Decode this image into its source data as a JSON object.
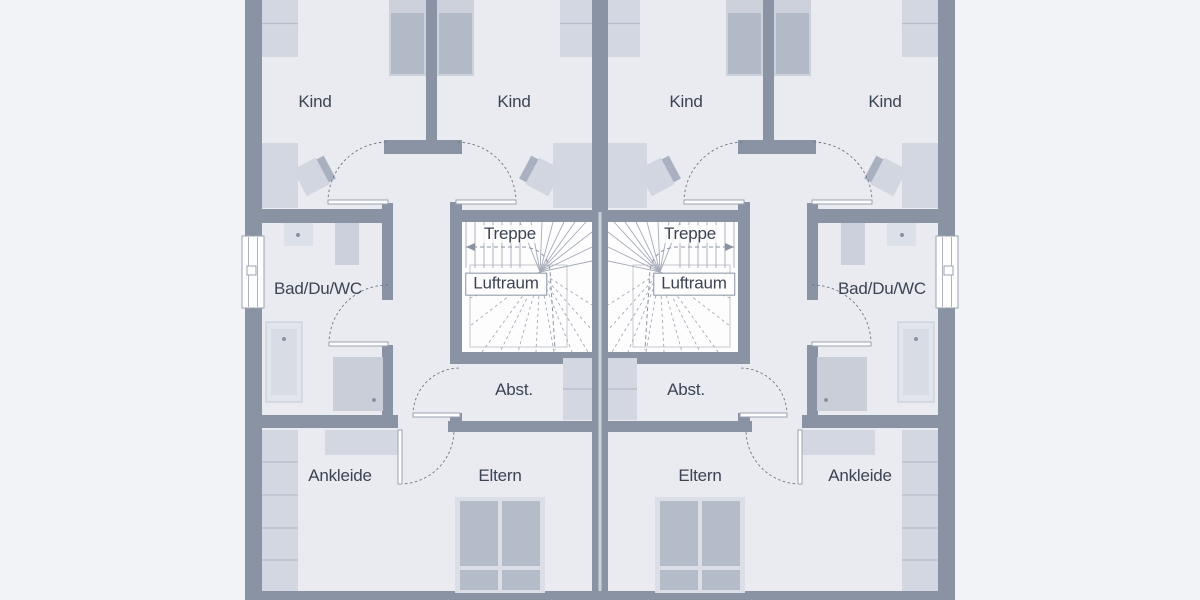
{
  "plan_type": "floor-plan-duplex-upper-storey",
  "colors": {
    "outside": "#f2f3f6",
    "floor": "#e9ebf1",
    "wall": "#8a93a4",
    "wall_seam": "#ccd1da",
    "stair_bg": "#fdfdfe",
    "stair_line": "#a5abb8",
    "void_line": "#b3b9c4",
    "walk_line": "#8a93a2",
    "furn_light": "#d3d7e1",
    "furn_mid": "#c9ced9",
    "bed_dark": "#b2b9c7",
    "bed_base": "#ccd1db",
    "dbl_bed_base": "#dbdee6",
    "dbl_bed_panel": "#b4bbc9",
    "tub_base": "#e2e5eb",
    "tub_inner": "#d8dce4",
    "tub_stroke": "#c4cad6",
    "basin": "#dce0e8",
    "wc": "#cbd0dc",
    "desk": "#d2d6e0",
    "desk_stripe": "#a9b0bf",
    "furn_line": "#b6bcc9",
    "door_arc": "#6e7482",
    "door_leaf_stroke": "#9aa2b1",
    "window_frame": "#9aa2b1",
    "dot": "#8a93a4",
    "text": "#3c4352"
  },
  "labels": [
    {
      "text": "Kind",
      "x": 315,
      "y": 102
    },
    {
      "text": "Kind",
      "x": 514,
      "y": 102
    },
    {
      "text": "Kind",
      "x": 686,
      "y": 102
    },
    {
      "text": "Kind",
      "x": 885,
      "y": 102
    },
    {
      "text": "Treppe",
      "x": 510,
      "y": 234,
      "halo": true
    },
    {
      "text": "Treppe",
      "x": 690,
      "y": 234,
      "halo": true
    },
    {
      "text": "Luftraum",
      "x": 506,
      "y": 284,
      "boxed": true
    },
    {
      "text": "Luftraum",
      "x": 694,
      "y": 284,
      "boxed": true
    },
    {
      "text": "Bad/Du/WC",
      "x": 318,
      "y": 289
    },
    {
      "text": "Bad/Du/WC",
      "x": 882,
      "y": 289
    },
    {
      "text": "Abst.",
      "x": 514,
      "y": 390
    },
    {
      "text": "Abst.",
      "x": 686,
      "y": 390
    },
    {
      "text": "Ankleide",
      "x": 340,
      "y": 476
    },
    {
      "text": "Eltern",
      "x": 500,
      "y": 476
    },
    {
      "text": "Eltern",
      "x": 700,
      "y": 476
    },
    {
      "text": "Ankleide",
      "x": 860,
      "y": 476
    }
  ],
  "shared": {
    "floor": [
      245,
      0,
      710,
      600
    ],
    "walls": [
      {
        "name": "outer-wall-left",
        "r": [
          245,
          0,
          17,
          600
        ]
      },
      {
        "name": "outer-wall-right",
        "r": [
          938,
          0,
          17,
          600
        ]
      },
      {
        "name": "outer-wall-bottom",
        "r": [
          245,
          591,
          710,
          9
        ]
      },
      {
        "name": "party-wall",
        "r": [
          592,
          0,
          16,
          591
        ]
      }
    ],
    "party_seam": [
      598.5,
      212,
      3,
      379
    ]
  },
  "unit": {
    "walls": [
      {
        "name": "kind-divider-wall",
        "r": [
          426,
          0,
          11,
          140
        ]
      },
      {
        "name": "hall-wing-wall",
        "r": [
          384,
          140,
          78,
          14
        ]
      },
      {
        "name": "hall-stub-wall",
        "r": [
          382,
          203,
          11,
          21
        ]
      },
      {
        "name": "bath-top-wall",
        "r": [
          262,
          209,
          120,
          14
        ]
      },
      {
        "name": "bath-right-wall-upper",
        "r": [
          382,
          223,
          11,
          77
        ]
      },
      {
        "name": "bath-right-wall-lower",
        "r": [
          382,
          345,
          11,
          71
        ]
      },
      {
        "name": "bath-bottom-wall",
        "r": [
          262,
          415,
          136,
          13
        ]
      },
      {
        "name": "stair-left-post",
        "r": [
          450,
          202,
          12,
          20
        ]
      },
      {
        "name": "stair-top-wall",
        "r": [
          450,
          210,
          142,
          12
        ]
      },
      {
        "name": "stair-left-wall",
        "r": [
          450,
          222,
          12,
          130
        ]
      },
      {
        "name": "stair-bottom-wall",
        "r": [
          450,
          352,
          142,
          12
        ]
      },
      {
        "name": "abst-door-post",
        "r": [
          450,
          413,
          12,
          19
        ]
      },
      {
        "name": "abst-bottom-wall",
        "r": [
          448,
          421,
          144,
          11
        ]
      }
    ],
    "windows": [
      {
        "name": "window",
        "r": [
          242,
          236,
          22,
          72
        ],
        "handle": [
          247,
          266,
          9,
          9
        ]
      }
    ],
    "furniture": [
      {
        "name": "wardrobe",
        "r": [
          262,
          0,
          36,
          57
        ],
        "fill": "furn_light",
        "lines": [
          [
            262,
            23.5,
            298,
            23.5
          ]
        ]
      },
      {
        "name": "nightstand",
        "r": [
          560,
          0,
          32,
          57
        ],
        "fill": "furn_light",
        "lines": [
          [
            560,
            23.5,
            592,
            23.5
          ]
        ]
      },
      {
        "name": "bed",
        "r": [
          389,
          0,
          37,
          76
        ],
        "fill": "bed_base",
        "inner": [
          [
            391,
            13,
            33,
            61,
            "bed_dark"
          ]
        ]
      },
      {
        "name": "bed",
        "r": [
          437,
          0,
          37,
          76
        ],
        "fill": "bed_base",
        "inner": [
          [
            439,
            13,
            33,
            61,
            "bed_dark"
          ]
        ]
      },
      {
        "name": "wardrobe",
        "r": [
          262,
          143,
          36,
          65
        ],
        "fill": "furn_light"
      },
      {
        "name": "wardrobe",
        "r": [
          553,
          143,
          39,
          65
        ],
        "fill": "furn_light"
      },
      {
        "name": "washbasin",
        "r": [
          284,
          223,
          29,
          23
        ],
        "fill": "basin",
        "dot": [
          298,
          235
        ]
      },
      {
        "name": "wc",
        "r": [
          335,
          223,
          24,
          42
        ],
        "fill": "wc"
      },
      {
        "name": "bathtub",
        "r": [
          266,
          322,
          36,
          80
        ],
        "fill": "tub_base",
        "stroke": "tub_stroke",
        "inner": [
          [
            271,
            329,
            26,
            66,
            "tub_inner"
          ]
        ],
        "dot": [
          284,
          339
        ]
      },
      {
        "name": "shower",
        "r": [
          333,
          357,
          50,
          54
        ],
        "fill": "furn_mid",
        "dot": [
          374,
          400
        ]
      },
      {
        "name": "wardrobe",
        "r": [
          325,
          430,
          73,
          25
        ],
        "fill": "furn_light"
      },
      {
        "name": "wardrobe",
        "r": [
          262,
          430,
          36,
          161
        ],
        "fill": "furn_light",
        "lines": [
          [
            262,
            462,
            298,
            462
          ],
          [
            262,
            495,
            298,
            495
          ],
          [
            262,
            528,
            298,
            528
          ],
          [
            262,
            560,
            298,
            560
          ]
        ]
      },
      {
        "name": "double-bed",
        "r": [
          455,
          497,
          90,
          96
        ],
        "fill": "dbl_bed_base",
        "inner": [
          [
            460,
            501,
            38,
            65,
            "dbl_bed_panel"
          ],
          [
            502,
            501,
            38,
            65,
            "dbl_bed_panel"
          ],
          [
            460,
            570,
            38,
            20,
            "dbl_bed_panel"
          ],
          [
            502,
            570,
            38,
            20,
            "dbl_bed_panel"
          ]
        ]
      },
      {
        "name": "cabinet",
        "r": [
          563,
          358,
          29,
          62
        ],
        "fill": "furn_light",
        "lines": [
          [
            563,
            389,
            592,
            389
          ]
        ]
      }
    ],
    "desks": [
      {
        "cx": 313,
        "cy": 176,
        "rot": -28,
        "flip": 1
      },
      {
        "cx": 542,
        "cy": 176,
        "rot": 28,
        "flip": -1
      }
    ],
    "doors": [
      {
        "name": "door-kind-left",
        "leaf": [
          328,
          200,
          60,
          4
        ],
        "arc": "M 328 202 A 60 60 0 0 1 388 142"
      },
      {
        "name": "door-kind-right",
        "leaf": [
          456,
          200,
          60,
          4
        ],
        "arc": "M 516 202 A 60 60 0 0 0 456 142"
      },
      {
        "name": "door-bath",
        "leaf": [
          329,
          342,
          59,
          4
        ],
        "arc": "M 329 344 A 59 59 0 0 1 388 285"
      },
      {
        "name": "door-abst",
        "leaf": [
          413,
          413,
          47,
          4
        ],
        "arc": "M 413 415 A 47 47 0 0 1 460 368"
      },
      {
        "name": "door-eltern",
        "leaf": [
          398,
          430,
          4,
          54
        ],
        "arc": "M 400 484 A 54 54 0 0 0 454 430"
      }
    ],
    "stairs": {
      "area": [
        462,
        222,
        130,
        130
      ],
      "void_rect": [
        470,
        265,
        97,
        82
      ],
      "treads": {
        "x0": 466,
        "dx": 9,
        "n": 7,
        "y0": 222,
        "y1": 268
      },
      "hub": [
        540,
        272
      ],
      "solid_rays": [
        [
          520,
          222
        ],
        [
          531,
          222
        ],
        [
          542,
          222
        ],
        [
          553,
          222
        ],
        [
          564,
          222
        ],
        [
          575,
          222
        ],
        [
          586,
          222
        ],
        [
          592,
          232
        ],
        [
          592,
          247
        ],
        [
          592,
          261
        ]
      ],
      "dashed_rays": [
        [
          470,
          298
        ],
        [
          470,
          326
        ],
        [
          482,
          352
        ],
        [
          500,
          352
        ],
        [
          518,
          352
        ],
        [
          536,
          352
        ],
        [
          554,
          352
        ],
        [
          572,
          352
        ],
        [
          588,
          352
        ],
        [
          592,
          330
        ],
        [
          592,
          305
        ]
      ],
      "walk_path": "M 466 247 L 524 247 Q 546 249 550 270 L 555 350",
      "walk_arrow": [
        [
          466,
          247
        ],
        [
          475,
          243
        ],
        [
          475,
          251
        ]
      ]
    }
  }
}
